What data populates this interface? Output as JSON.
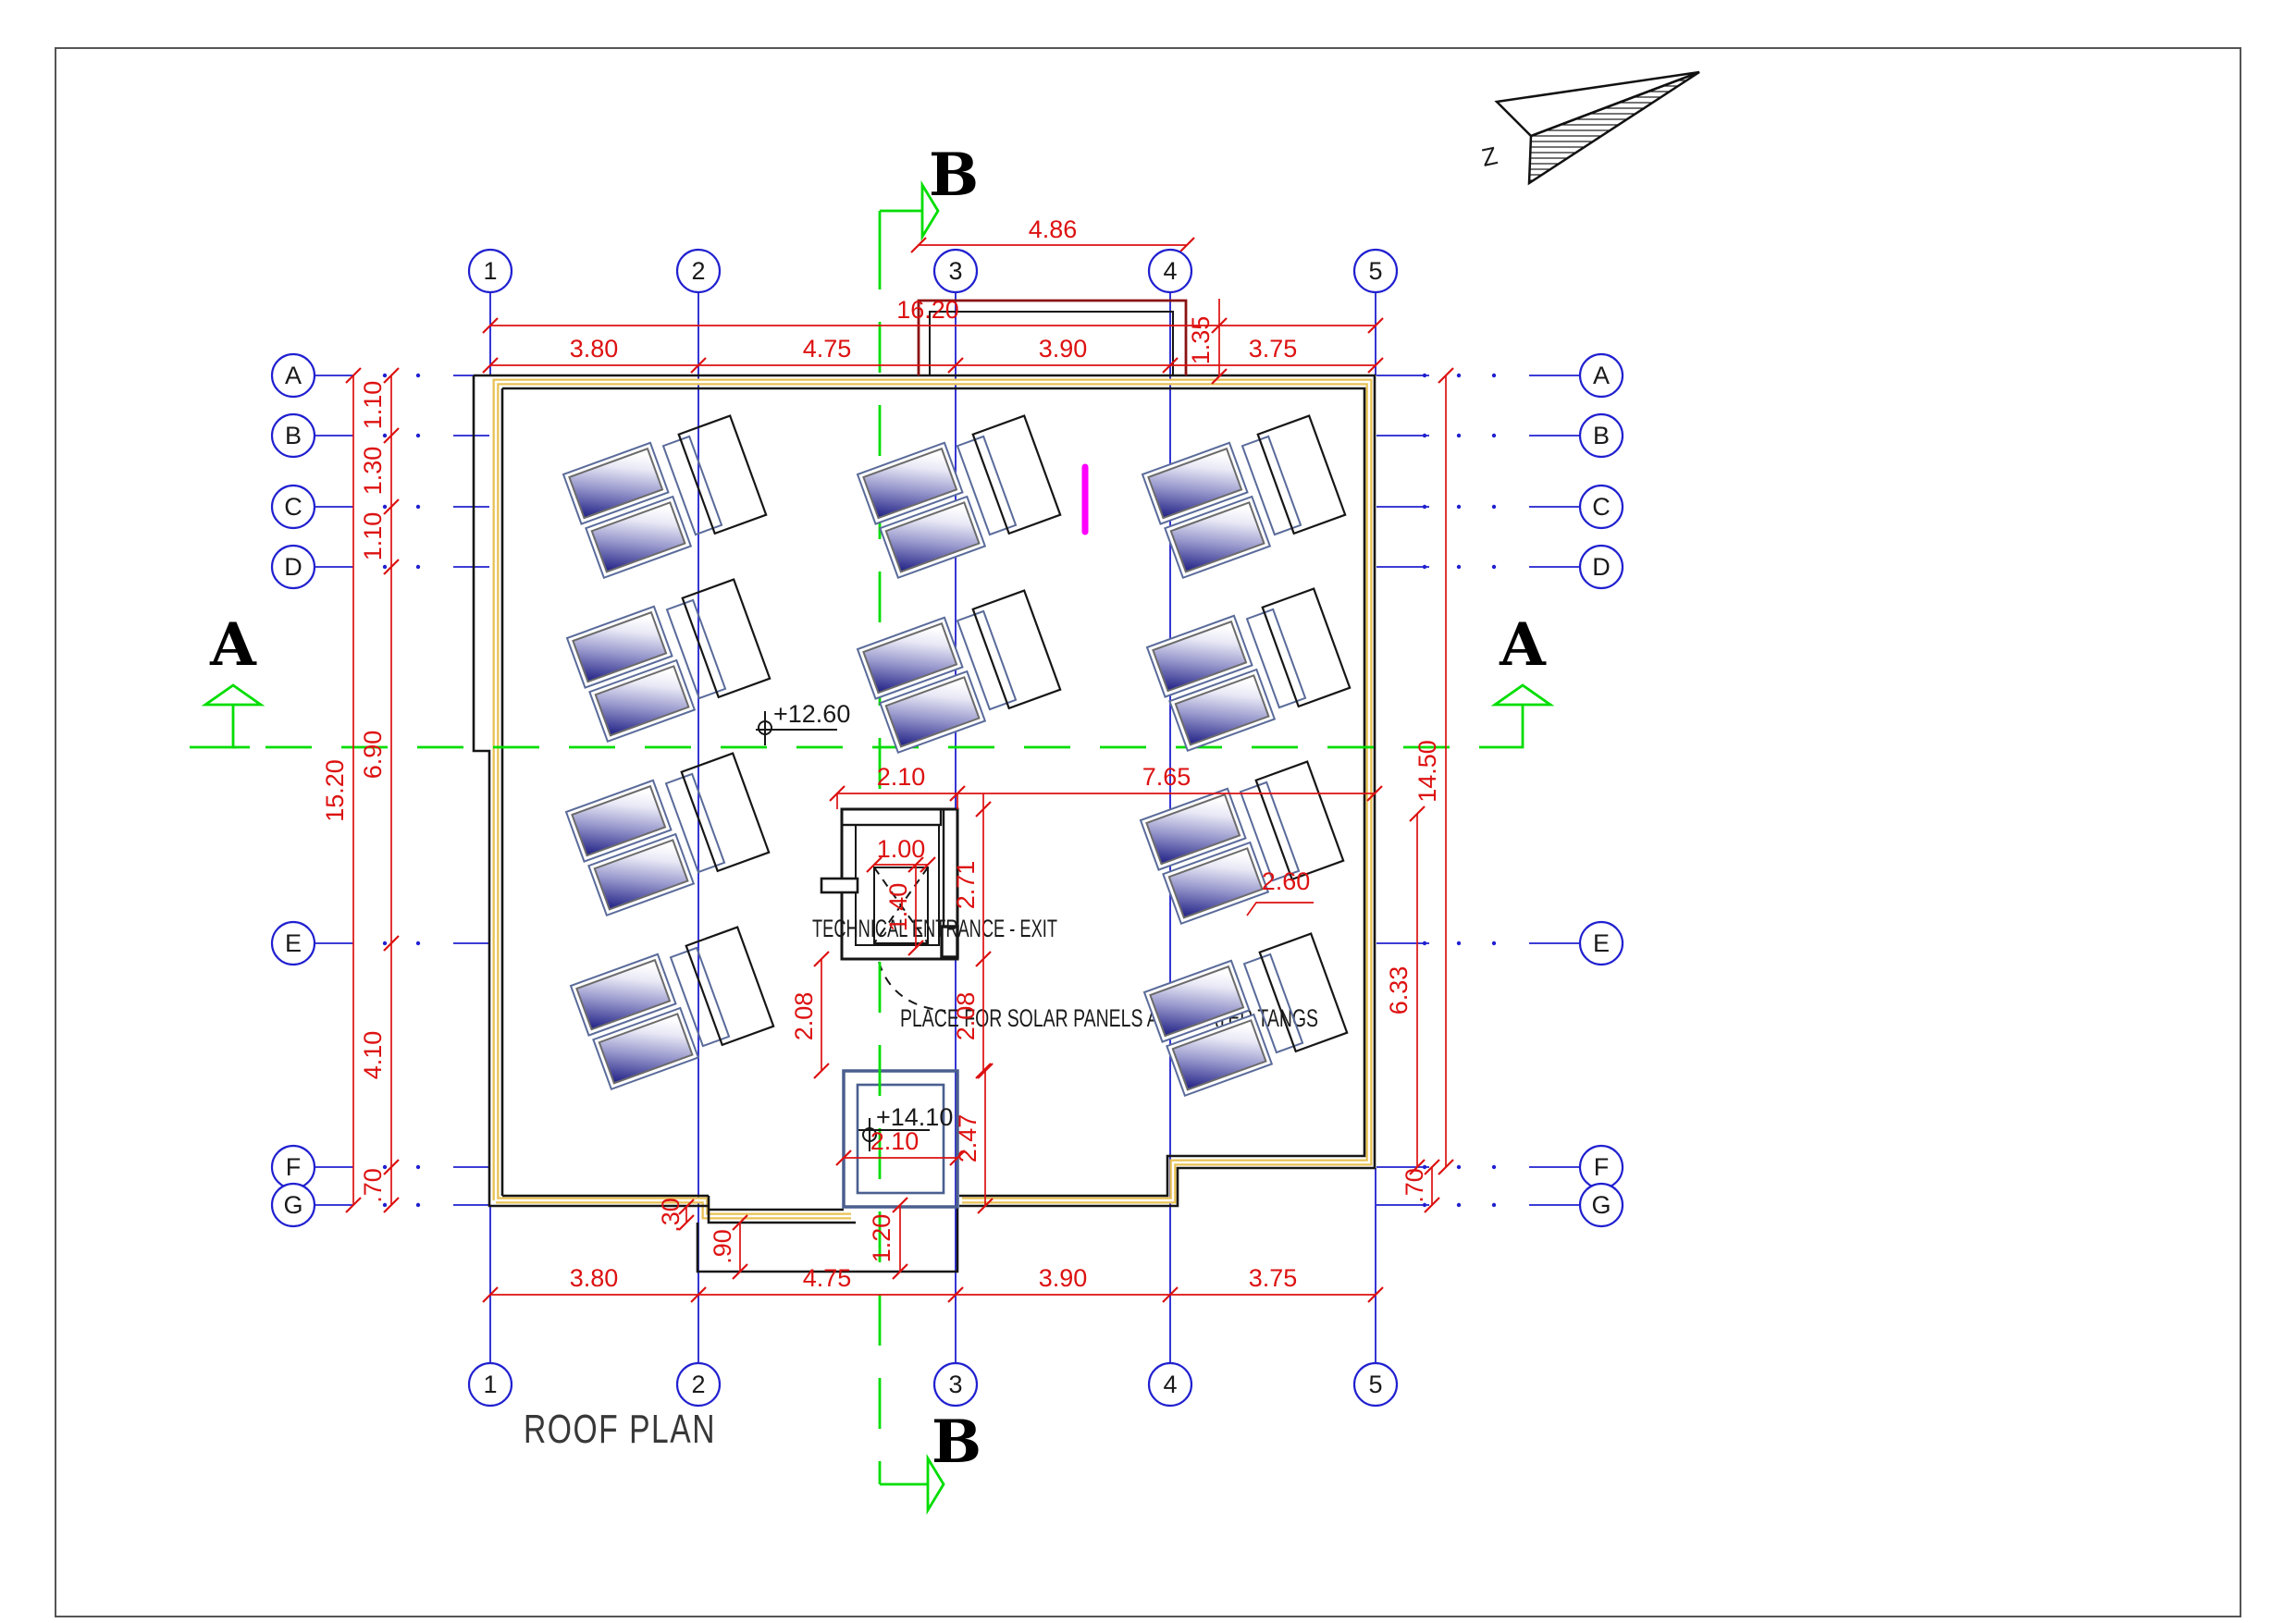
{
  "page": {
    "title": "ROOF PLAN"
  },
  "north": {
    "label": "Z"
  },
  "sections": {
    "a_left": "A",
    "a_right": "A",
    "b_top": "B",
    "b_bottom": "B"
  },
  "grid": {
    "cols": [
      "1",
      "2",
      "3",
      "4",
      "5"
    ],
    "rows": [
      "A",
      "B",
      "C",
      "D",
      "E",
      "F",
      "G"
    ]
  },
  "annotations": {
    "technical_entrance": "TECHNICAL ENTRANCE - EXIT",
    "solar_place": "PLACE FOR SOLAR PANELS AND WATER TANGS",
    "elev_roof": "+12.60",
    "elev_bulkhead": "+14.10"
  },
  "dims": {
    "protrusion_width": "4.86",
    "top_overall": "16.20",
    "protrusion_height": "1.35",
    "col_1_2": "3.80",
    "col_2_3": "4.75",
    "col_3_4": "3.90",
    "col_4_5": "3.75",
    "left_overall": "15.20",
    "row_a_b": "1.10",
    "row_b_c": "1.30",
    "row_c_d": "1.10",
    "row_d_e": "6.90",
    "row_e_f": "4.10",
    "row_f_g": ".70",
    "right_overall": "14.50",
    "right_e_f": "6.33",
    "right_f_g": ".70",
    "panel_spacing": "2.60",
    "entrance_width": "2.10",
    "entrance_to_wall": "7.65",
    "hatch_width": "1.00",
    "hatch_height": "1.40",
    "entrance_height": "2.71",
    "gap_below_left": "2.08",
    "gap_below_right": "2.08",
    "bulkhead_width": "2.10",
    "bulkhead_height": "2.47",
    "stair_depth": "1.20",
    "stair_step": ".90",
    "notch_step": ".30"
  },
  "colors": {
    "dimension_red": "#dd1111",
    "grid_blue": "#2020d0",
    "section_green": "#00dd00",
    "wall_yellow": "#e8c154",
    "panel_navy": "#1f1f85",
    "panel_frame_blue": "#5a6b9a",
    "bulkhead_slate": "#4a5f8f",
    "protrusion_maroon": "#8a1212",
    "highlight_magenta": "#ff00ff"
  }
}
